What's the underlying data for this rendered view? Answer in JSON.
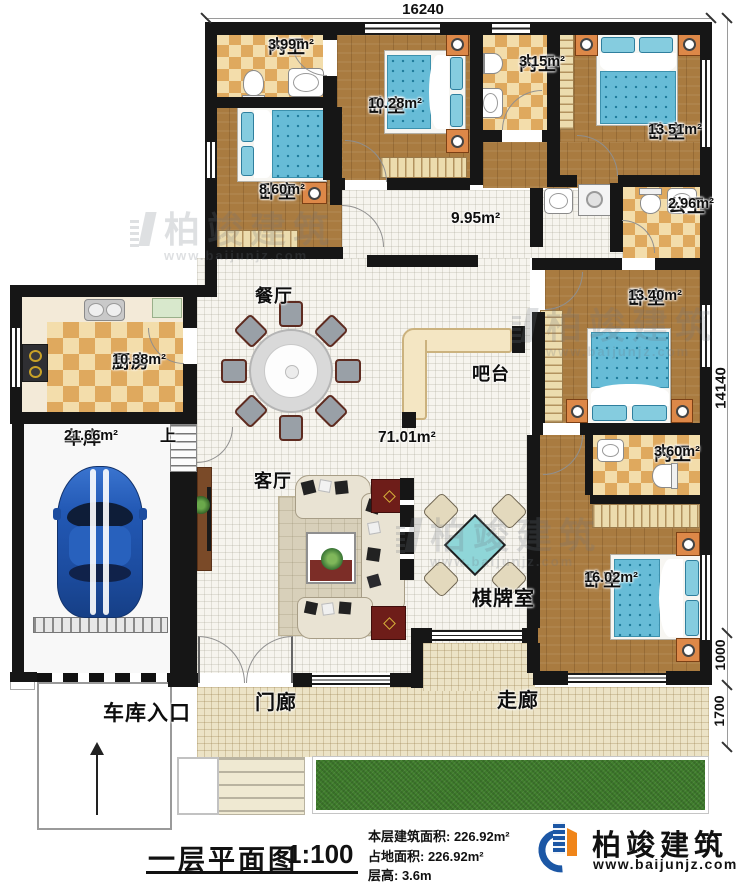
{
  "dimensions": {
    "top": "16240",
    "right_total": "14140",
    "right_mid": "1000",
    "right_bottom": "1700"
  },
  "rooms": {
    "bath_ensuite_a": {
      "name": "内卫",
      "area": "3.99m²"
    },
    "bedroom_b": {
      "name": "卧室",
      "area": "10.28m²"
    },
    "bath_ensuite_b": {
      "name": "内卫",
      "area": "3.15m²"
    },
    "bedroom_c": {
      "name": "卧室",
      "area": "13.51m²"
    },
    "bedroom_a": {
      "name": "卧室",
      "area": "8.60m²"
    },
    "bath_public": {
      "name": "公卫",
      "area": "2.96m²"
    },
    "hallway": {
      "area": "9.95m²"
    },
    "bedroom_d": {
      "name": "卧室",
      "area": "13.40m²"
    },
    "dining": {
      "name": "餐厅"
    },
    "kitchen": {
      "name": "厨房",
      "area": "10.38m²"
    },
    "bar": {
      "name": "吧台"
    },
    "open_area": {
      "area": "71.01m²"
    },
    "garage": {
      "name": "车库",
      "area": "21.66m²"
    },
    "stairs_up": {
      "label": "上"
    },
    "living": {
      "name": "客厅"
    },
    "bath_ensuite_c": {
      "name": "内卫",
      "area": "3.60m²"
    },
    "chess_room": {
      "name": "棋牌室"
    },
    "bedroom_e": {
      "name": "卧室",
      "area": "16.02m²"
    },
    "garage_entrance": {
      "name": "车库入口"
    },
    "porch": {
      "name": "门廊"
    },
    "corridor": {
      "name": "走廊"
    }
  },
  "title_block": {
    "plan_title": "一层平面图",
    "scale": "1:100",
    "floor_area": "本层建筑面积: 226.92m²",
    "land_area": "占地面积: 226.92m²",
    "floor_height": "层高: 3.6m"
  },
  "brand": {
    "name": "柏竣建筑",
    "website": "www.baijunjz.com"
  },
  "watermark": {
    "name": "柏竣建筑",
    "website": "www.baijunjz.com"
  },
  "colors": {
    "wall": "#161616",
    "wood_floor": "#a97b40",
    "checker_dark": "#dfa95e",
    "checker_light": "#f3ddab",
    "bed_blue": "#67bcd7",
    "grass": "#3f7d2c",
    "brand_blue": "#1c57a5",
    "brand_orange": "#f08519"
  }
}
